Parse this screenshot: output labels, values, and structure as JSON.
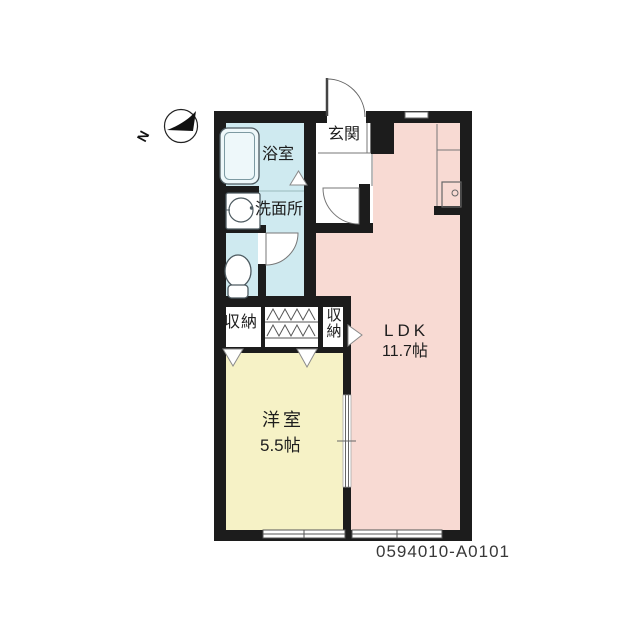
{
  "meta": {
    "type": "apartment-floor-plan",
    "plan_code": "0594010-A0101"
  },
  "compass": {
    "label": "N"
  },
  "rooms": {
    "entrance": {
      "label": "玄関"
    },
    "bathroom": {
      "label": "浴室"
    },
    "washroom": {
      "label": "洗面所"
    },
    "closet_left": {
      "label": "収納"
    },
    "closet_right": {
      "label": "収納"
    },
    "ldk": {
      "label": "LDK",
      "size": "11.7帖"
    },
    "western_room": {
      "label": "洋室",
      "size": "5.5帖"
    }
  },
  "fixtures": {
    "bathtub": "bathtub-icon",
    "washbasin": "washbasin-icon",
    "toilet": "toilet-icon",
    "kitchen_sink": "kitchen-sink-icon",
    "compass": "compass-north-icon"
  },
  "colors": {
    "wall": "#1c1c1c",
    "ldk_floor": "#f8dad3",
    "wet_floor": "#cfeaf0",
    "western_floor": "#f6f2c6",
    "line": "#777777"
  }
}
